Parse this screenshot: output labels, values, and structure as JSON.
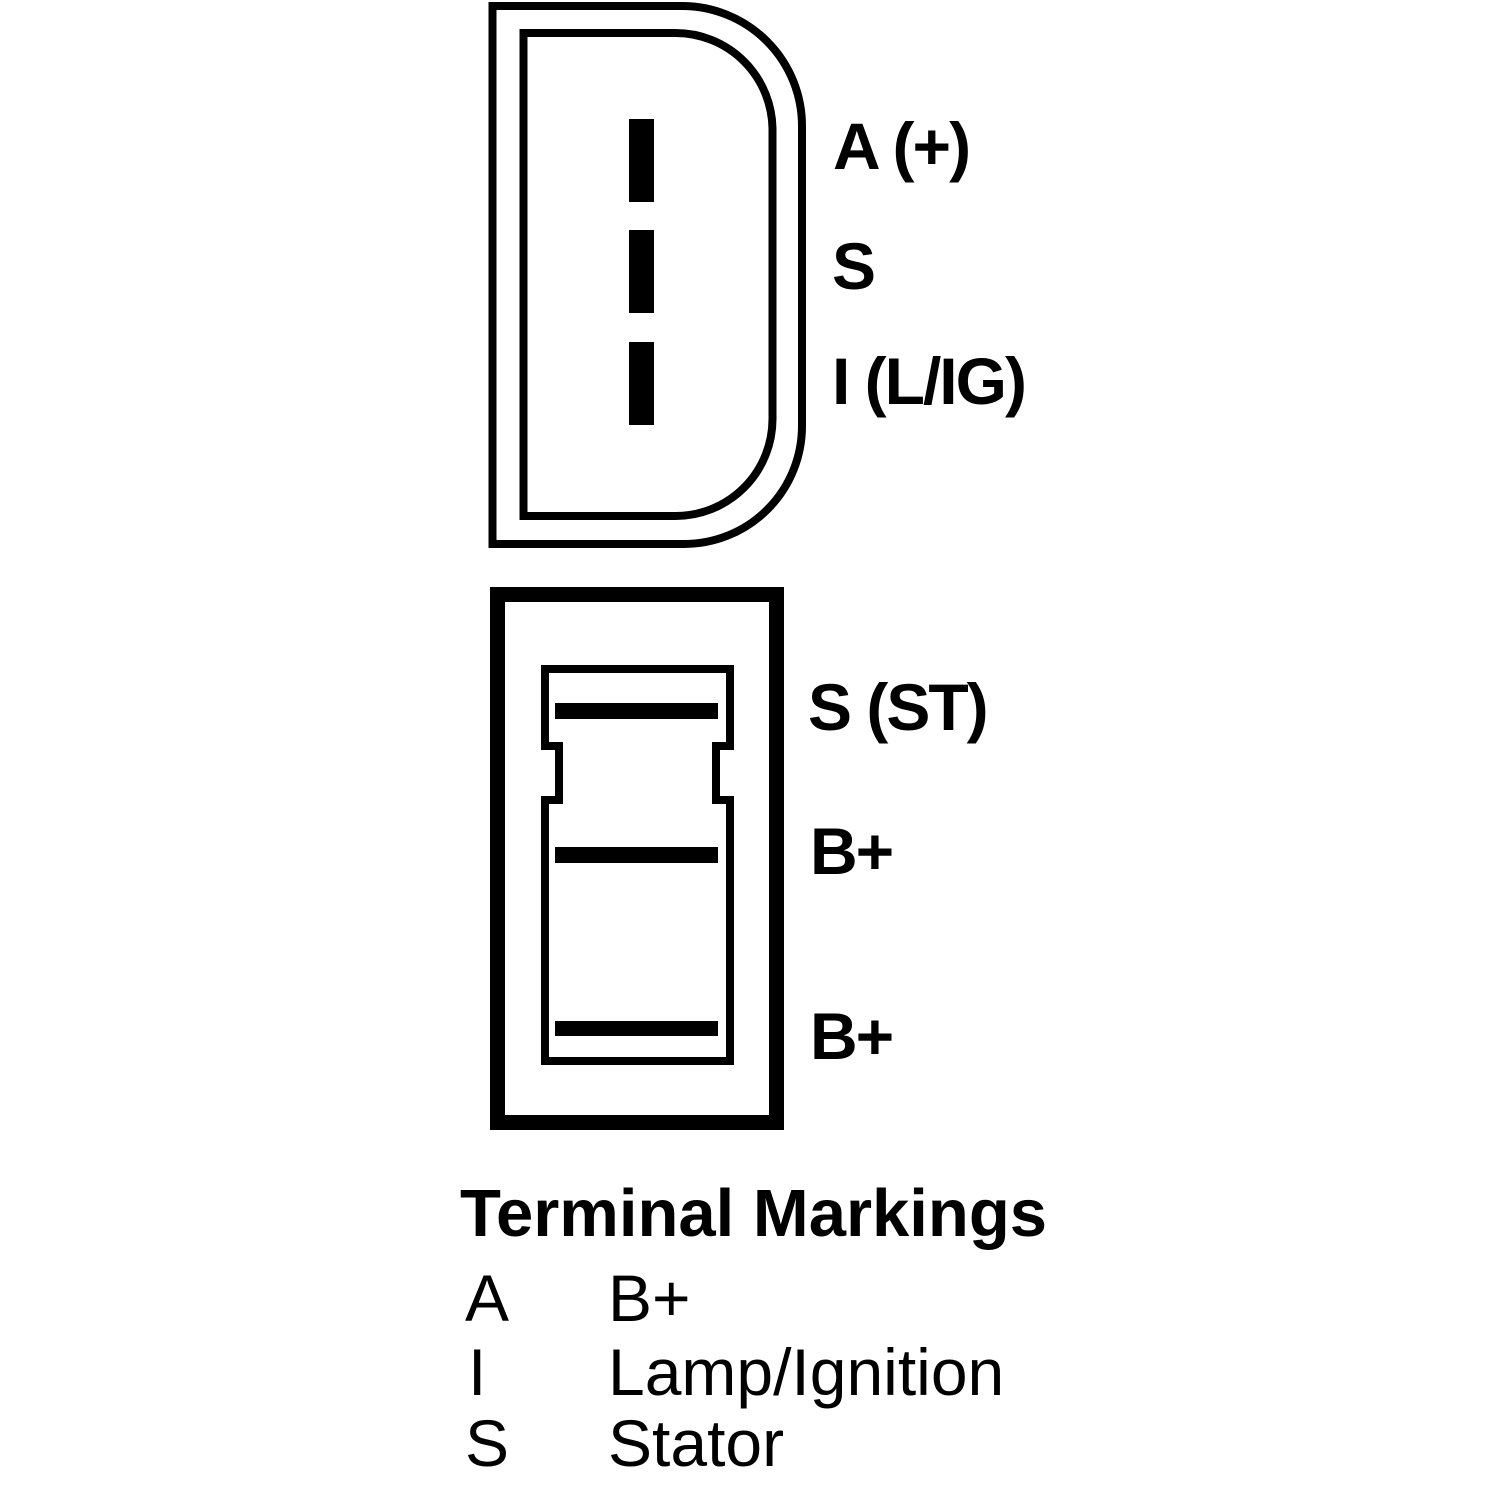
{
  "canvas": {
    "background": "#ffffff",
    "line_color": "#000000"
  },
  "top_connector": {
    "description": "d-shaped-regulator-plug",
    "pin_labels": [
      {
        "label": "A (+)"
      },
      {
        "label": "S"
      },
      {
        "label": "I (L/IG)"
      }
    ]
  },
  "bottom_connector": {
    "description": "rectangular-terminal-block",
    "pin_labels": [
      {
        "label": "S (ST)"
      },
      {
        "label": "B+"
      },
      {
        "label": "B+"
      }
    ]
  },
  "legend": {
    "title": "Terminal Markings",
    "rows": [
      {
        "mark": "A",
        "meaning": "B+"
      },
      {
        "mark": "I",
        "meaning": "Lamp/Ignition"
      },
      {
        "mark": "S",
        "meaning": "Stator"
      }
    ]
  }
}
